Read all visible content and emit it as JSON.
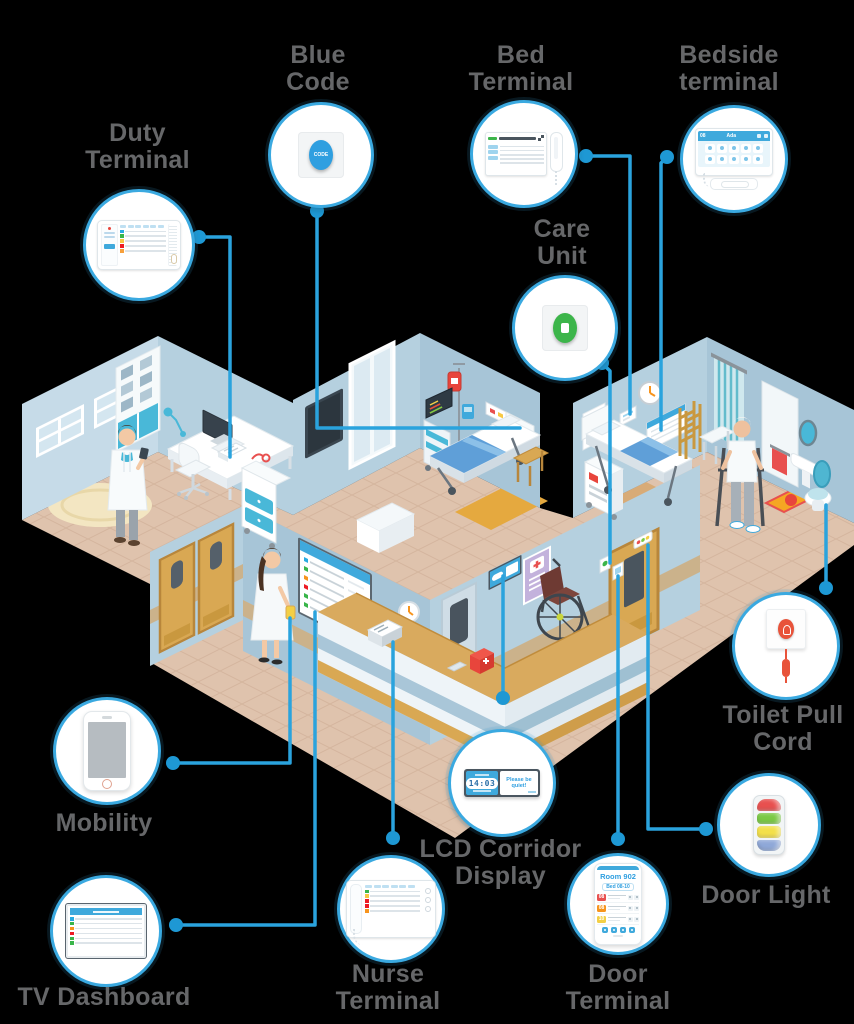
{
  "scene": {
    "description": "Isometric hospital ward illustration: doctor's office, two patient rooms, corridor with nurse station, wheelchair, doctor, nurse and patient figures"
  },
  "colors": {
    "accent": "#2aa3dd",
    "dot": "#1e98d4",
    "circle_border": "#3aa9e0",
    "label_text": "#666769"
  },
  "callouts": {
    "duty_terminal": {
      "label": "Duty Terminal",
      "row_colors": [
        "#29abe2",
        "#39b54a",
        "#f7c843",
        "#ed1c24",
        "#f7a03c"
      ]
    },
    "blue_code": {
      "label": "Blue Code",
      "button_text": "CODE",
      "button_color": "#2f9fe0"
    },
    "bed_terminal": {
      "label": "Bed Terminal"
    },
    "bedside_terminal": {
      "label": "Bedside terminal",
      "header_time": "08",
      "patient_name": "Ada"
    },
    "care_unit": {
      "label": "Care Unit",
      "button_color": "#3cb54a"
    },
    "toilet_pull_cord": {
      "label": "Toilet Pull Cord"
    },
    "door_light": {
      "label": "Door Light",
      "segment_colors": [
        "#e8504f",
        "#7ac943",
        "#f3e04a",
        "#8fa8d8"
      ]
    },
    "mobility": {
      "label": "Mobility"
    },
    "tv_dashboard": {
      "label": "TV Dashboard",
      "row_colors": [
        "#29abe2",
        "#39b54a",
        "#f7941d",
        "#ed1c24",
        "#39b54a",
        "#39b54a"
      ]
    },
    "nurse_terminal": {
      "label": "Nurse Terminal",
      "row_colors": [
        "#39b54a",
        "#f7c843",
        "#ed1c24",
        "#ed1c24",
        "#f7941d"
      ]
    },
    "lcd_corridor_display": {
      "label": "LCD Corridor Display",
      "time": "14:03",
      "message": "Please be quiet!"
    },
    "door_terminal": {
      "label": "Door Terminal",
      "room": "Room 902",
      "bed": "Bed 08-10",
      "call_rows": [
        {
          "num": "08",
          "color": "#e8504f"
        },
        {
          "num": "08",
          "color": "#f7941d"
        },
        {
          "num": "10",
          "color": "#f3cf45"
        }
      ]
    }
  }
}
